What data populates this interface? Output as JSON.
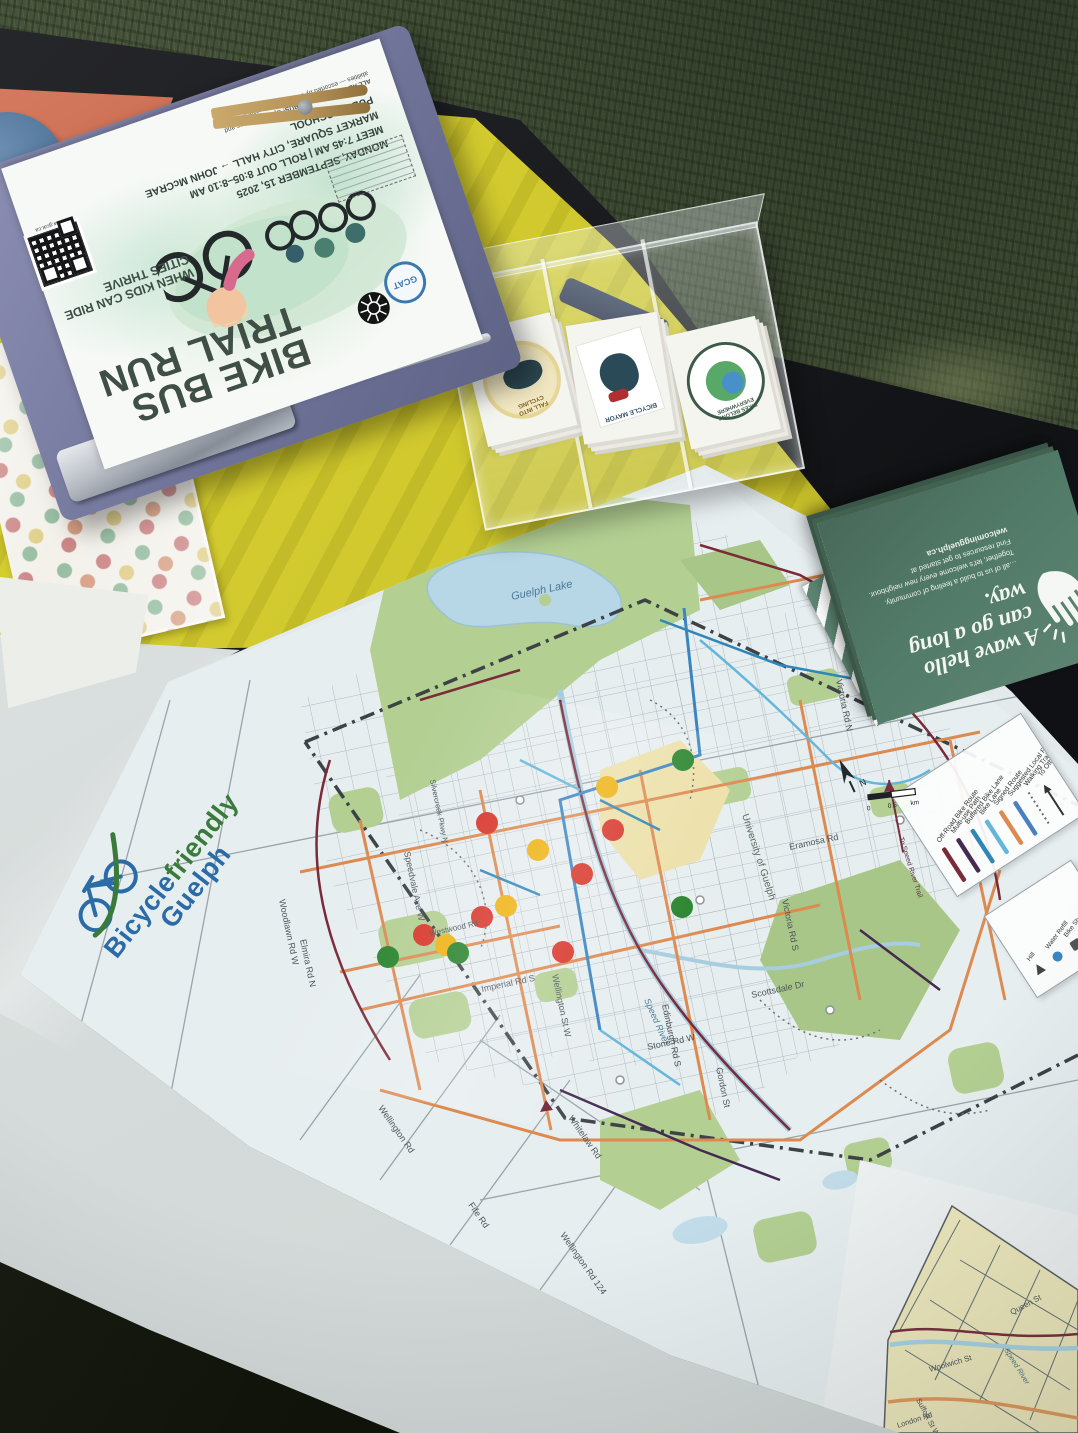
{
  "flyer": {
    "title_line1": "BIKE BUS",
    "title_line2": "TRIAL RUN",
    "subtitle_line1": "WHEN KIDS CAN RIDE",
    "subtitle_line2": "CITIES THRIVE",
    "date_line": "MONDAY, SEPTEMBER 15, 2025",
    "time_line": "MEET 7:45 AM | ROLL OUT 8:05–8:10 AM",
    "route_line": "MARKET SQUARE, CITY HALL → JOHN McCRAE PUBLIC SCHOOL",
    "fine_print_1": "ALL ABOARD THE BIKE BUS!",
    "fine_print_2": "Open to all ages and abilities — escorted by community volunteers.",
    "qr_caption": "www.gcat.ca",
    "org_logo": "GCAT"
  },
  "sticker_box": {
    "stickers": [
      {
        "label_line1": "FALL INTO",
        "label_line2": "CYCLING"
      },
      {
        "label_line1": "BICYCLE",
        "label_line2": "MAYOR"
      },
      {
        "label_line1": "BIKES BELONG",
        "label_line2": "EVERYWHERE"
      }
    ]
  },
  "pamphlet": {
    "headline_line1": "A wave hello",
    "headline_line2": "can go a long way.",
    "body_line1": "…all of us to build a feeling of community.",
    "body_line2": "Together, let's welcome every new neighbour.",
    "body_line3": "Find resources to get started at",
    "site": "welcomingguelph.ca"
  },
  "map": {
    "logo_word1": "Bicycle",
    "logo_word2": "friendly",
    "logo_word3": "Guelph",
    "street_labels": [
      "Guelph Lake",
      "Woodlawn Rd W",
      "Speedvale Ave W",
      "Westwood Rd",
      "Imperial Rd S",
      "Wellington St W",
      "Edinburgh Rd S",
      "Gordon St",
      "Victoria Rd S",
      "Victoria Rd N",
      "Stone Rd W",
      "Scottsdale Dr",
      "Eramosa Rd",
      "Elmira Rd N",
      "Silvercreek Pkwy N",
      "University of Guelph",
      "Speed River",
      "Wellington Rd 124",
      "Fife Rd",
      "Whitelaw Rd",
      "Wellington Rd",
      "Forestell Rd",
      "Concession 4"
    ],
    "inset_labels": [
      "Woolwich St",
      "Queen St",
      "Suffolk St W",
      "Speed River",
      "London Rd"
    ],
    "legend": {
      "items": [
        {
          "label": "Off-Road Bike Route",
          "color": "#7a2a38"
        },
        {
          "label": "Multi-use Path",
          "color": "#452a52"
        },
        {
          "label": "Buffered Bike Lane",
          "color": "#2f86b8"
        },
        {
          "label": "Bike Lane",
          "color": "#66b6dc"
        },
        {
          "label": "Signed Route",
          "color": "#dd8a50"
        },
        {
          "label": "Suggested Local Route",
          "color": "#4a7fc0"
        },
        {
          "label": "Walking Trails",
          "color": "#6a6f73"
        },
        {
          "label": "To Other County Trails",
          "color": "#333333"
        }
      ],
      "poi": [
        {
          "label": "Hill"
        },
        {
          "label": "Water Refill"
        },
        {
          "label": "Bike Shop"
        },
        {
          "label": "Bike Parking"
        }
      ],
      "trail_note": "To Speed River Trail"
    },
    "scale": {
      "zero": "0",
      "half": "0.5",
      "unit": "km",
      "north": "N"
    },
    "dots": [
      {
        "color": "#27832c",
        "x": 683,
        "y": 760
      },
      {
        "color": "#eeb211",
        "x": 607,
        "y": 787
      },
      {
        "color": "#d8352a",
        "x": 487,
        "y": 823
      },
      {
        "color": "#d8352a",
        "x": 613,
        "y": 830
      },
      {
        "color": "#eeb211",
        "x": 538,
        "y": 850
      },
      {
        "color": "#d8352a",
        "x": 582,
        "y": 874
      },
      {
        "color": "#eeb211",
        "x": 506,
        "y": 906
      },
      {
        "color": "#27832c",
        "x": 682,
        "y": 907
      },
      {
        "color": "#d8352a",
        "x": 482,
        "y": 917
      },
      {
        "color": "#d8352a",
        "x": 424,
        "y": 935
      },
      {
        "color": "#eeb211",
        "x": 446,
        "y": 945
      },
      {
        "color": "#27832c",
        "x": 458,
        "y": 953
      },
      {
        "color": "#27832c",
        "x": 388,
        "y": 957
      },
      {
        "color": "#d8352a",
        "x": 563,
        "y": 952
      }
    ]
  },
  "colors": {
    "tablecloth": "#d3cb31",
    "table": "#1b1c1e",
    "grass": "#47543c",
    "clipboard": "#7e81a6",
    "pamphlet_green": "#557d6b",
    "map_paper": "#e9eef0",
    "dot_red": "#d8352a",
    "dot_yellow": "#eeb211",
    "dot_green": "#27832c"
  }
}
